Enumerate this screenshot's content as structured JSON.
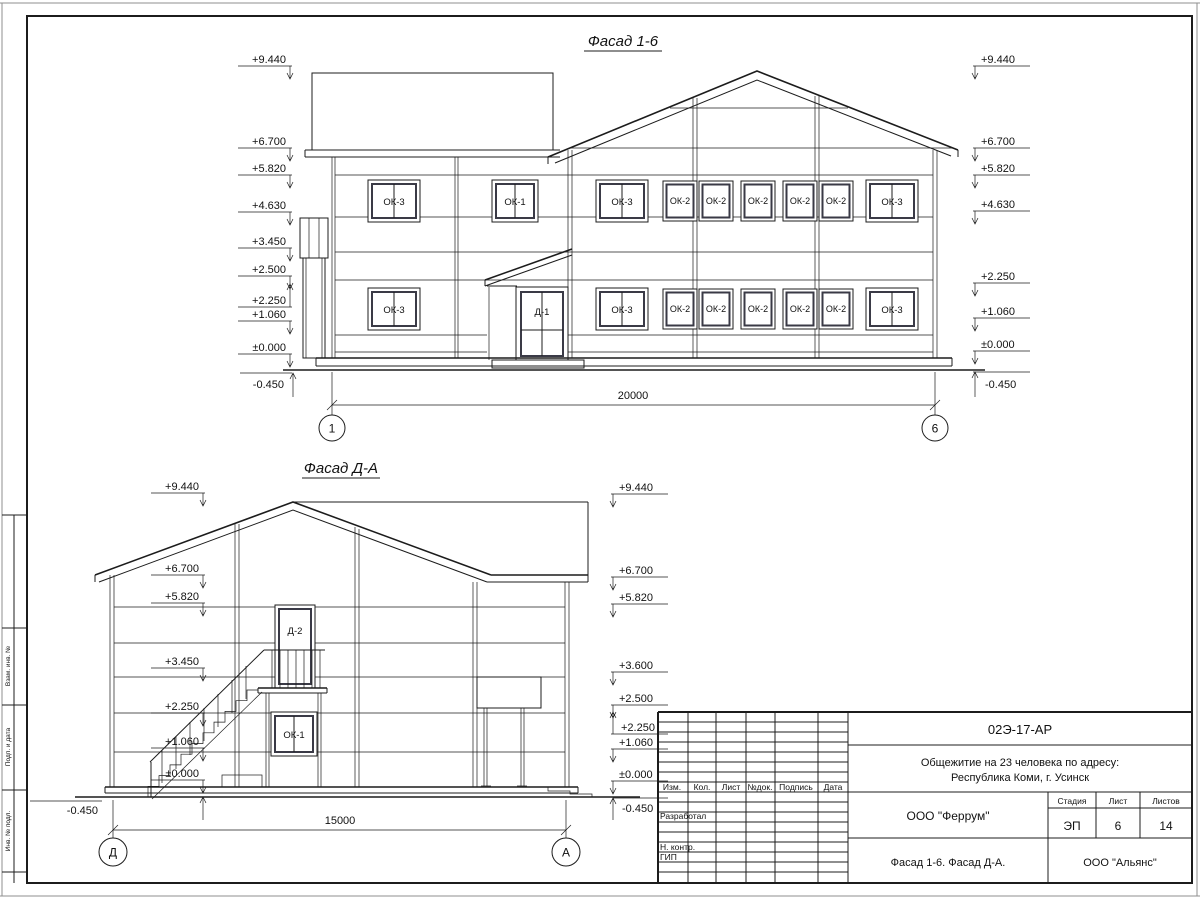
{
  "titles": {
    "facade16": "Фасад 1-6",
    "facadeDA": "Фасад Д-А"
  },
  "facade16": {
    "marks_left": [
      "+9.440",
      "+6.700",
      "+5.820",
      "+4.630",
      "+3.450",
      "+2.500",
      "+2.250",
      "+1.060",
      "±0.000",
      "-0.450"
    ],
    "marks_right": [
      "+9.440",
      "+6.700",
      "+5.820",
      "+4.630",
      "+2.250",
      "+1.060",
      "±0.000",
      "-0.450"
    ],
    "upper_windows": [
      "ОК-3",
      "ОК-1",
      "ОК-3",
      "ОК-2",
      "ОК-2",
      "ОК-2",
      "ОК-2",
      "ОК-2",
      "ОК-3"
    ],
    "lower_windows": [
      "ОК-3",
      "ОК-3",
      "ОК-2",
      "ОК-2",
      "ОК-2",
      "ОК-2",
      "ОК-2",
      "ОК-3"
    ],
    "door_label": "Д-1",
    "dimension": "20000",
    "axis_start": "1",
    "axis_end": "6"
  },
  "facadeDA": {
    "marks_left": [
      "+9.440",
      "+6.700",
      "+5.820",
      "+3.450",
      "+2.250",
      "+1.060",
      "±0.000",
      "-0.450"
    ],
    "marks_right": [
      "+9.440",
      "+6.700",
      "+5.820",
      "+3.600",
      "+2.500",
      "+2.250",
      "+1.060",
      "±0.000",
      "-0.450"
    ],
    "door_label": "Д-2",
    "window_label": "ОК-1",
    "dimension": "15000",
    "axis_start": "Д",
    "axis_end": "А"
  },
  "margin": {
    "labels": [
      "Взам. инв. №",
      "Подп. и дата",
      "Инв. № подл."
    ]
  },
  "stamp": {
    "doc_number": "02Э-17-АР",
    "project_line1": "Общежитие на 23 человека по адресу:",
    "project_line2": "Республика Коми, г. Усинск",
    "columns": [
      "Изм.",
      "Кол.",
      "Лист",
      "№док.",
      "Подпись",
      "Дата"
    ],
    "row_developed": "Разработал",
    "row_ncontrol": "Н. контр.",
    "row_gip": "ГИП",
    "org": "ООО \"Феррум\"",
    "stage_label": "Стадия",
    "sheet_label": "Лист",
    "sheets_label": "Листов",
    "stage": "ЭП",
    "sheet": "6",
    "sheets": "14",
    "content_title": "Фасад 1-6. Фасад Д-А.",
    "contractor": "ООО \"Альянс\""
  }
}
